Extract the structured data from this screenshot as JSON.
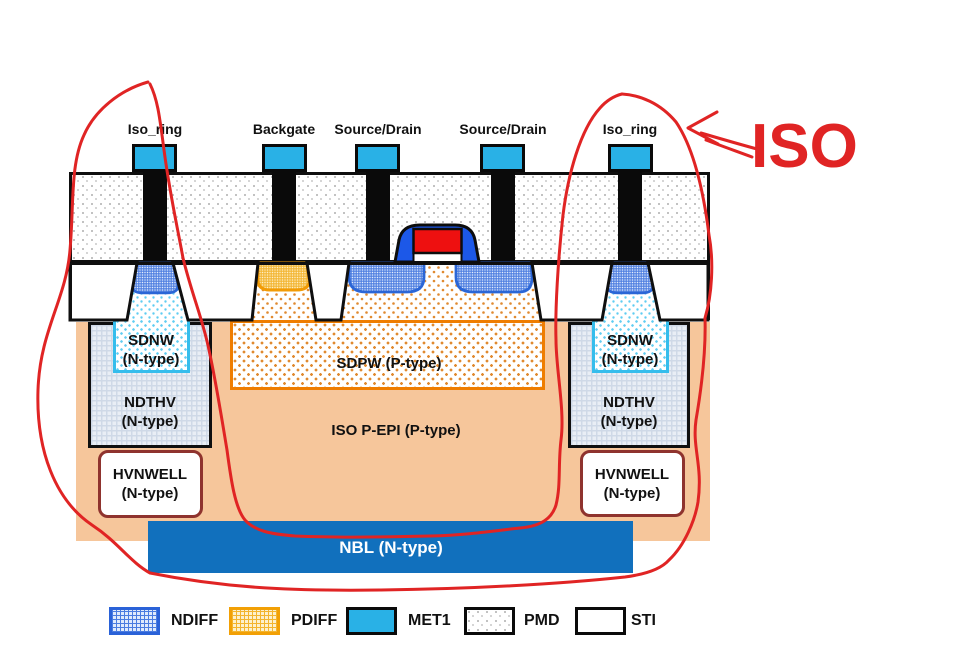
{
  "title": "ISO device cross-section diagram",
  "annotation": {
    "iso_label": "ISO"
  },
  "top_labels": [
    {
      "label": "Iso_ring"
    },
    {
      "label": "Backgate"
    },
    {
      "label": "Source/Drain"
    },
    {
      "label": "Source/Drain"
    },
    {
      "label": "Iso_ring"
    }
  ],
  "regions": {
    "sdnw_name": "SDNW",
    "sdnw_type": "(N-type)",
    "ndthv_name": "NDTHV",
    "ndthv_type": "(N-type)",
    "hvnwell_name": "HVNWELL",
    "hvnwell_type": "(N-type)",
    "sdpw_label": "SDPW (P-type)",
    "epi_label": "ISO P-EPI (P-type)",
    "nbl_label": "NBL (N-type)"
  },
  "legend": {
    "items": [
      {
        "label": "NDIFF"
      },
      {
        "label": "PDIFF"
      },
      {
        "label": "MET1"
      },
      {
        "label": "PMD"
      },
      {
        "label": "STI"
      }
    ]
  },
  "colors": {
    "met1": "#29b1e6",
    "nbl": "#1170bd",
    "epi": "#f6c69b",
    "red": "#e02424",
    "ndiff": "#2b66d6",
    "pdiff": "#f2a005",
    "sdnw": "#35bdec",
    "sdpw": "#ef7d00",
    "hvnwell": "#8f332e",
    "gate_blue": "#1c58e8",
    "gate_red": "#ee1010"
  }
}
